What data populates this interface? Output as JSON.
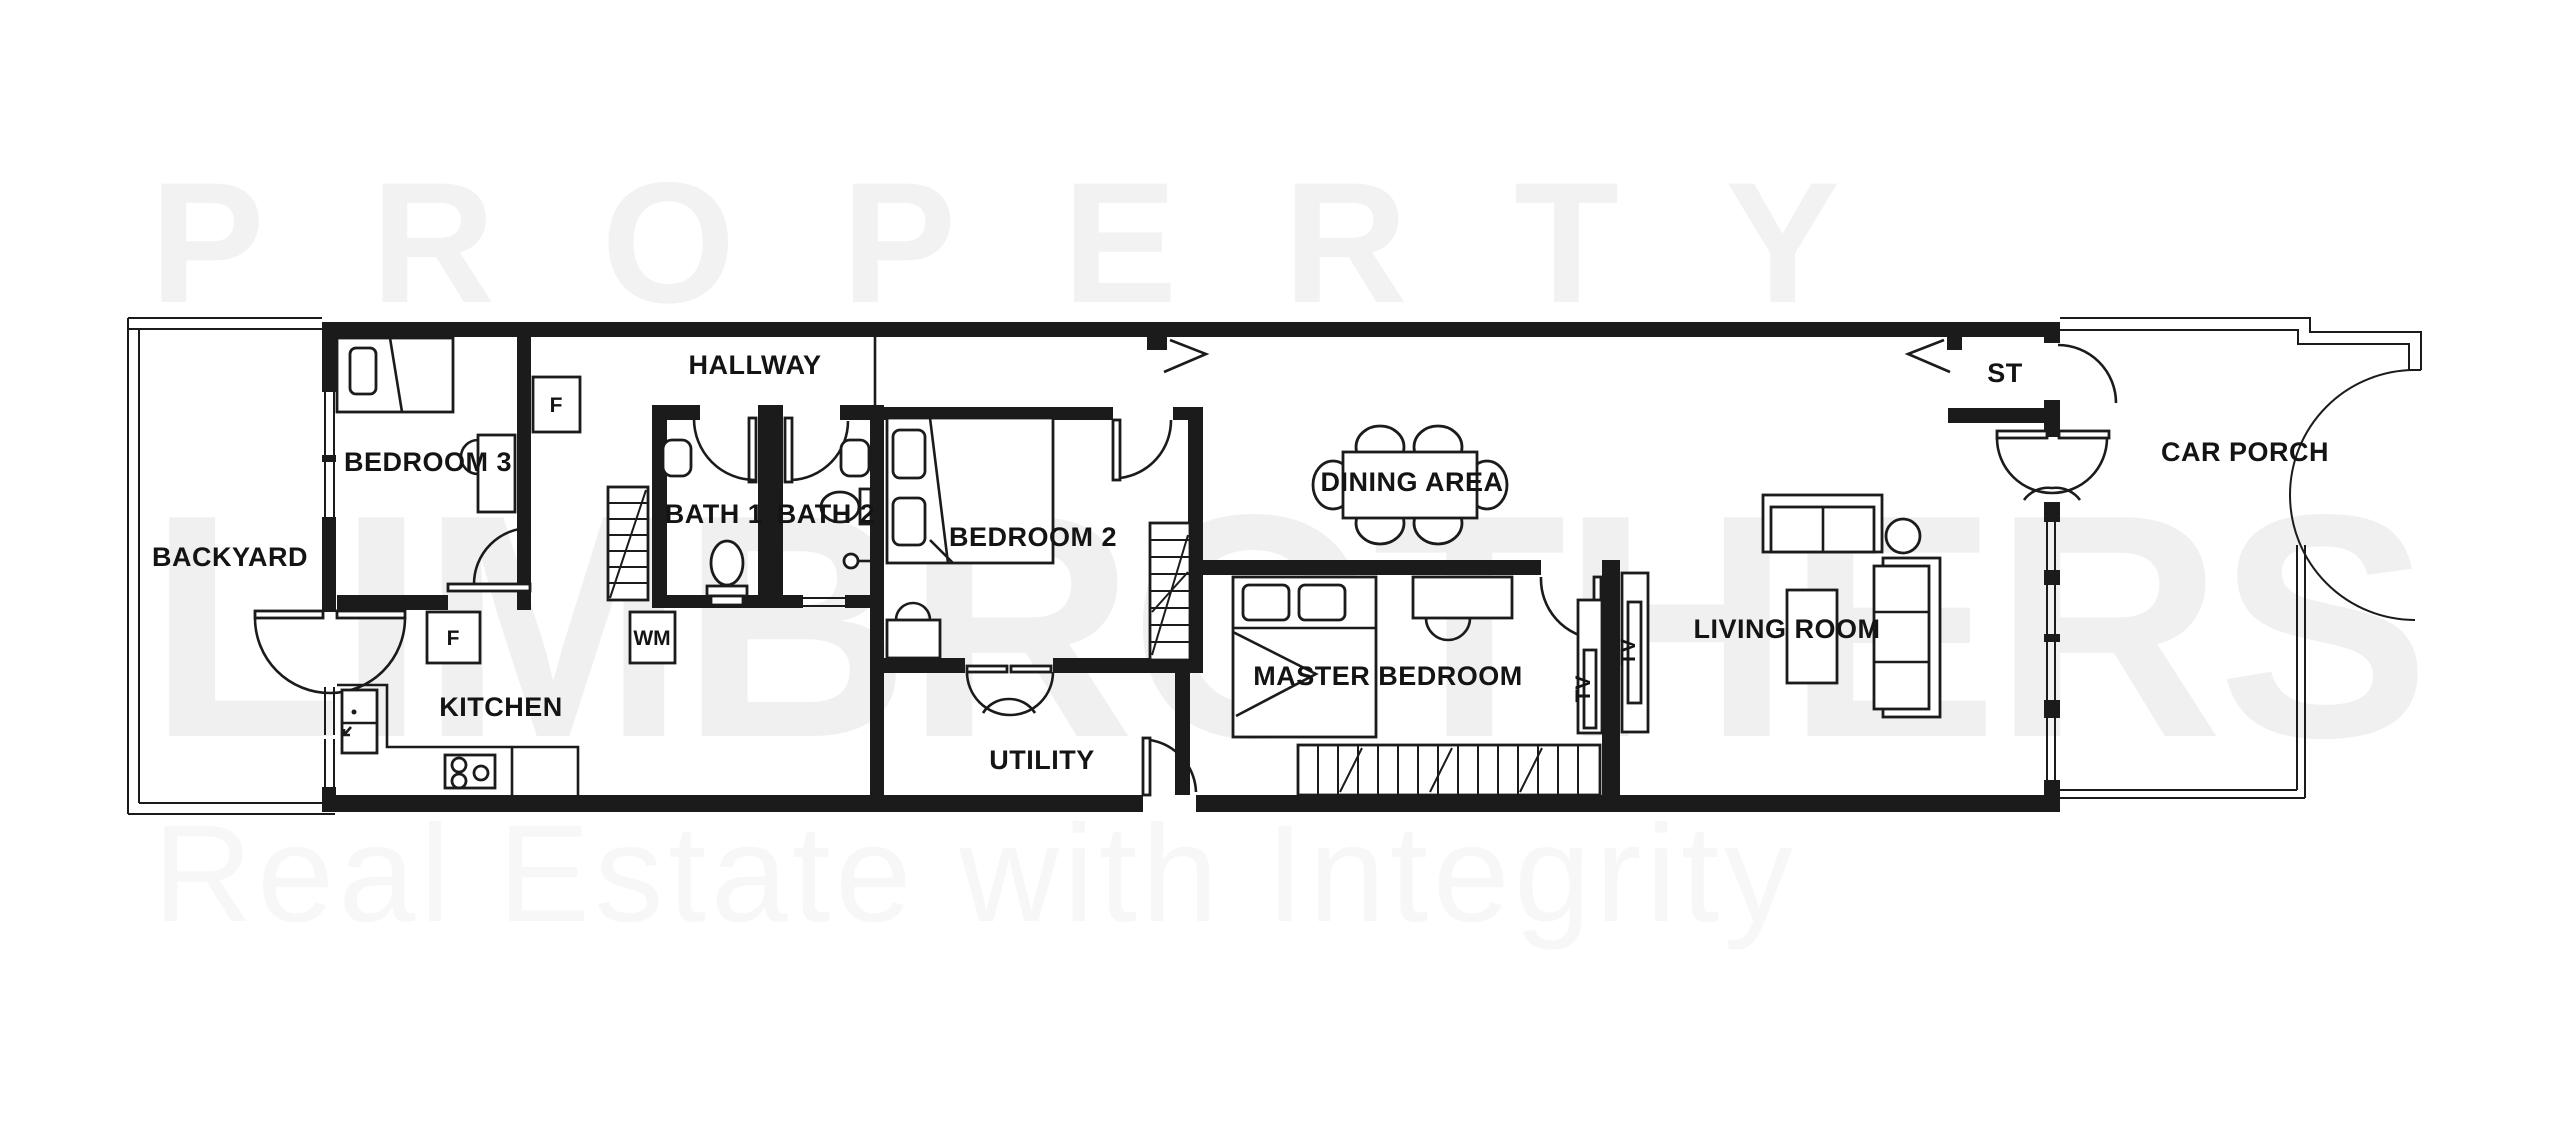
{
  "watermark": {
    "top": "PROPERTY",
    "middle": "LIMBROTHERS",
    "bottom": "Real Estate with Integrity"
  },
  "rooms": [
    {
      "id": "backyard",
      "label": "BACKYARD"
    },
    {
      "id": "bedroom3",
      "label": "BEDROOM 3"
    },
    {
      "id": "hallway",
      "label": "HALLWAY"
    },
    {
      "id": "bath1",
      "label": "BATH 1"
    },
    {
      "id": "bath2",
      "label": "BATH 2"
    },
    {
      "id": "bedroom2",
      "label": "BEDROOM 2"
    },
    {
      "id": "kitchen",
      "label": "KITCHEN"
    },
    {
      "id": "utility",
      "label": "UTILITY"
    },
    {
      "id": "dining-area",
      "label": "DINING AREA"
    },
    {
      "id": "master-bedroom",
      "label": "MASTER BEDROOM"
    },
    {
      "id": "living-room",
      "label": "LIVING ROOM"
    },
    {
      "id": "store",
      "label": "ST"
    },
    {
      "id": "car-porch",
      "label": "CAR PORCH"
    }
  ],
  "appliances": {
    "fridge_hallway": "F",
    "fridge_kitchen": "F",
    "washing_machine": "WM",
    "tv_master": "TV",
    "tv_living": "TV"
  },
  "colors": {
    "wall": "#1b1b1b",
    "background": "#ffffff",
    "watermark_top": "#f2f2f2",
    "watermark_middle": "#f0f0f0",
    "watermark_bottom": "#f7f7f7",
    "label": "#141414"
  }
}
